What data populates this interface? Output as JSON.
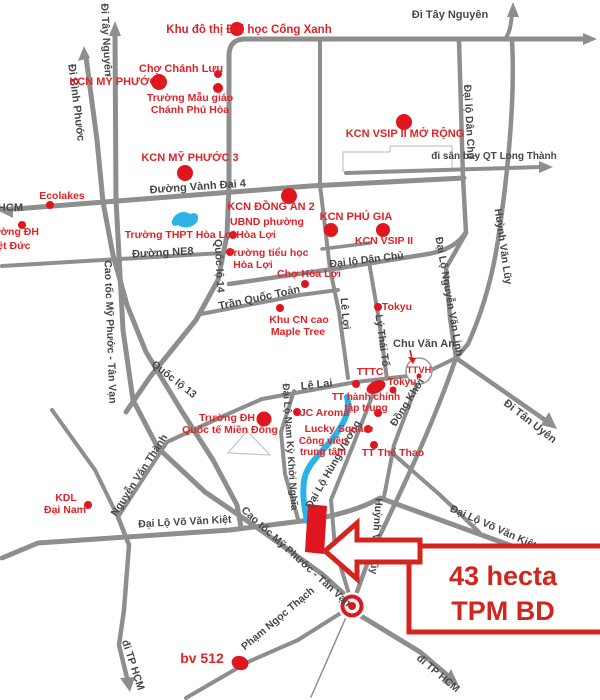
{
  "colors": {
    "red_text": "#e02327",
    "red_marker": "#e0161f",
    "road_gray": "#8e8e8e",
    "water_blue": "#2bb3e8",
    "callout_red": "#d3251d"
  },
  "callout": {
    "line1": "43 hecta",
    "line2": "TPM BD"
  },
  "roads": {
    "di_binh_phuoc": "Đi Bình Phước",
    "di_tay_nguyen_left": "Đi Tây Nguyên",
    "di_tay_nguyen_top": "Đi Tây Nguyên",
    "tp_hcm": "TP HCM",
    "vanh_dai_4": "Đường Vành Đai 4",
    "ne8": "Đường NE8",
    "quoc_lo_14": "Quốc lộ 14",
    "quoc_lo_13": "Quốc lộ 13",
    "cao_toc_left": "Cao tốc Mỹ Phước - Tân Vạn",
    "cao_toc_south": "Cao tốc Mỹ Phước - Tân Vạn",
    "dan_chu_v": "Đại lộ Dân Chủ",
    "dan_chu_h": "Đại lộ Dân Chủ",
    "di_san_bay": "đi sân bay QT Long Thành",
    "tran_quoc_toan": "Trần Quốc Toản",
    "le_loi": "Lê Lợi",
    "ly_thai_to": "Lý Thái Tổ",
    "chu_van_an": "Chu Văn An",
    "le_lai": "Lê Lai",
    "dong_khoi": "Đồng Khởi",
    "huynh_van_luy_n": "Huỳnh Văn Lũy",
    "huynh_van_luy_s": "Huỳnh Văn Lũy",
    "nguyen_van_linh": "Đại Lộ Nguyễn Văn Linh",
    "di_tan_uyen": "Đi Tân Uyên",
    "nguyen_van_thanh": "Nguyễn Văn Thành",
    "nam_ky_khoi_nghia": "Đại Lộ Nam Kỳ Khởi Nghĩa",
    "hung_vuong": "Đại Lộ Hùng Vương",
    "vo_van_kiet_w": "Đại Lộ Võ Văn Kiệt",
    "vo_van_kiet_e": "Đại Lộ Võ Văn Kiệt",
    "pham_ngoc_thach": "Phạm Ngọc Thạch",
    "di_tp_hcm_sw": "đi TP HCM",
    "di_tp_hcm_se": "đi TP HCM"
  },
  "places": {
    "khu_do_thi": "Khu đô thị Đại học Cống Xanh",
    "kcn_my_phuoc_2": "KCN MỸ PHƯỚC 2",
    "cho_chanh_luu": "Chợ Chánh Lưu",
    "mau_giao_1": "Trường Mẫu giáo",
    "mau_giao_2": "Chánh Phú Hòa",
    "kcn_vsip2_mr": "KCN VSIP II MỞ RỘNG",
    "kcn_my_phuoc_3": "KCN MỸ PHƯỚC 3",
    "ecolakes": "Ecolakes",
    "kcn_dong_an_2": "KCN ĐỒNG AN 2",
    "thpt_hoa_loi": "Trường THPT Hòa Lợi",
    "ubnd_1": "UBND phường",
    "ubnd_2": "Hòa Lợi",
    "kcn_phu_gia": "KCN PHÚ GIA",
    "kcn_vsip_2": "KCN VSIP II",
    "tieu_hoc_1": "Trường tiểu học",
    "tieu_hoc_2": "Hòa Lợi",
    "dh_viet_duc_1": "Trường ĐH",
    "dh_viet_duc_2": "Việt Đức",
    "cho_hoa_loi": "Chợ Hòa Lợi",
    "tokyu_1": "Tokyu",
    "khu_cn_cao_1": "Khu CN cao",
    "khu_cn_cao_2": "Maple Tree",
    "tttc": "TTTC",
    "ttvh": "TTVH",
    "tokyu_2": "Tokyu",
    "tt_hanh_chinh_1": "TT hành chính",
    "tt_hanh_chinh_2": "tập trung",
    "ijc_aroma": "IJC Aroma",
    "dh_mien_dong_1": "Trường ĐH",
    "dh_mien_dong_2": "Quốc tế Miền Đông",
    "lucky_square": "Lucky Square",
    "cong_vien_1": "Công viên",
    "cong_vien_2": "trung tâm",
    "tt_the_thao": "TT Thể Thao",
    "kdl_1": "KDL",
    "kdl_2": "Đại Nam",
    "bv_512": "bv 512"
  }
}
